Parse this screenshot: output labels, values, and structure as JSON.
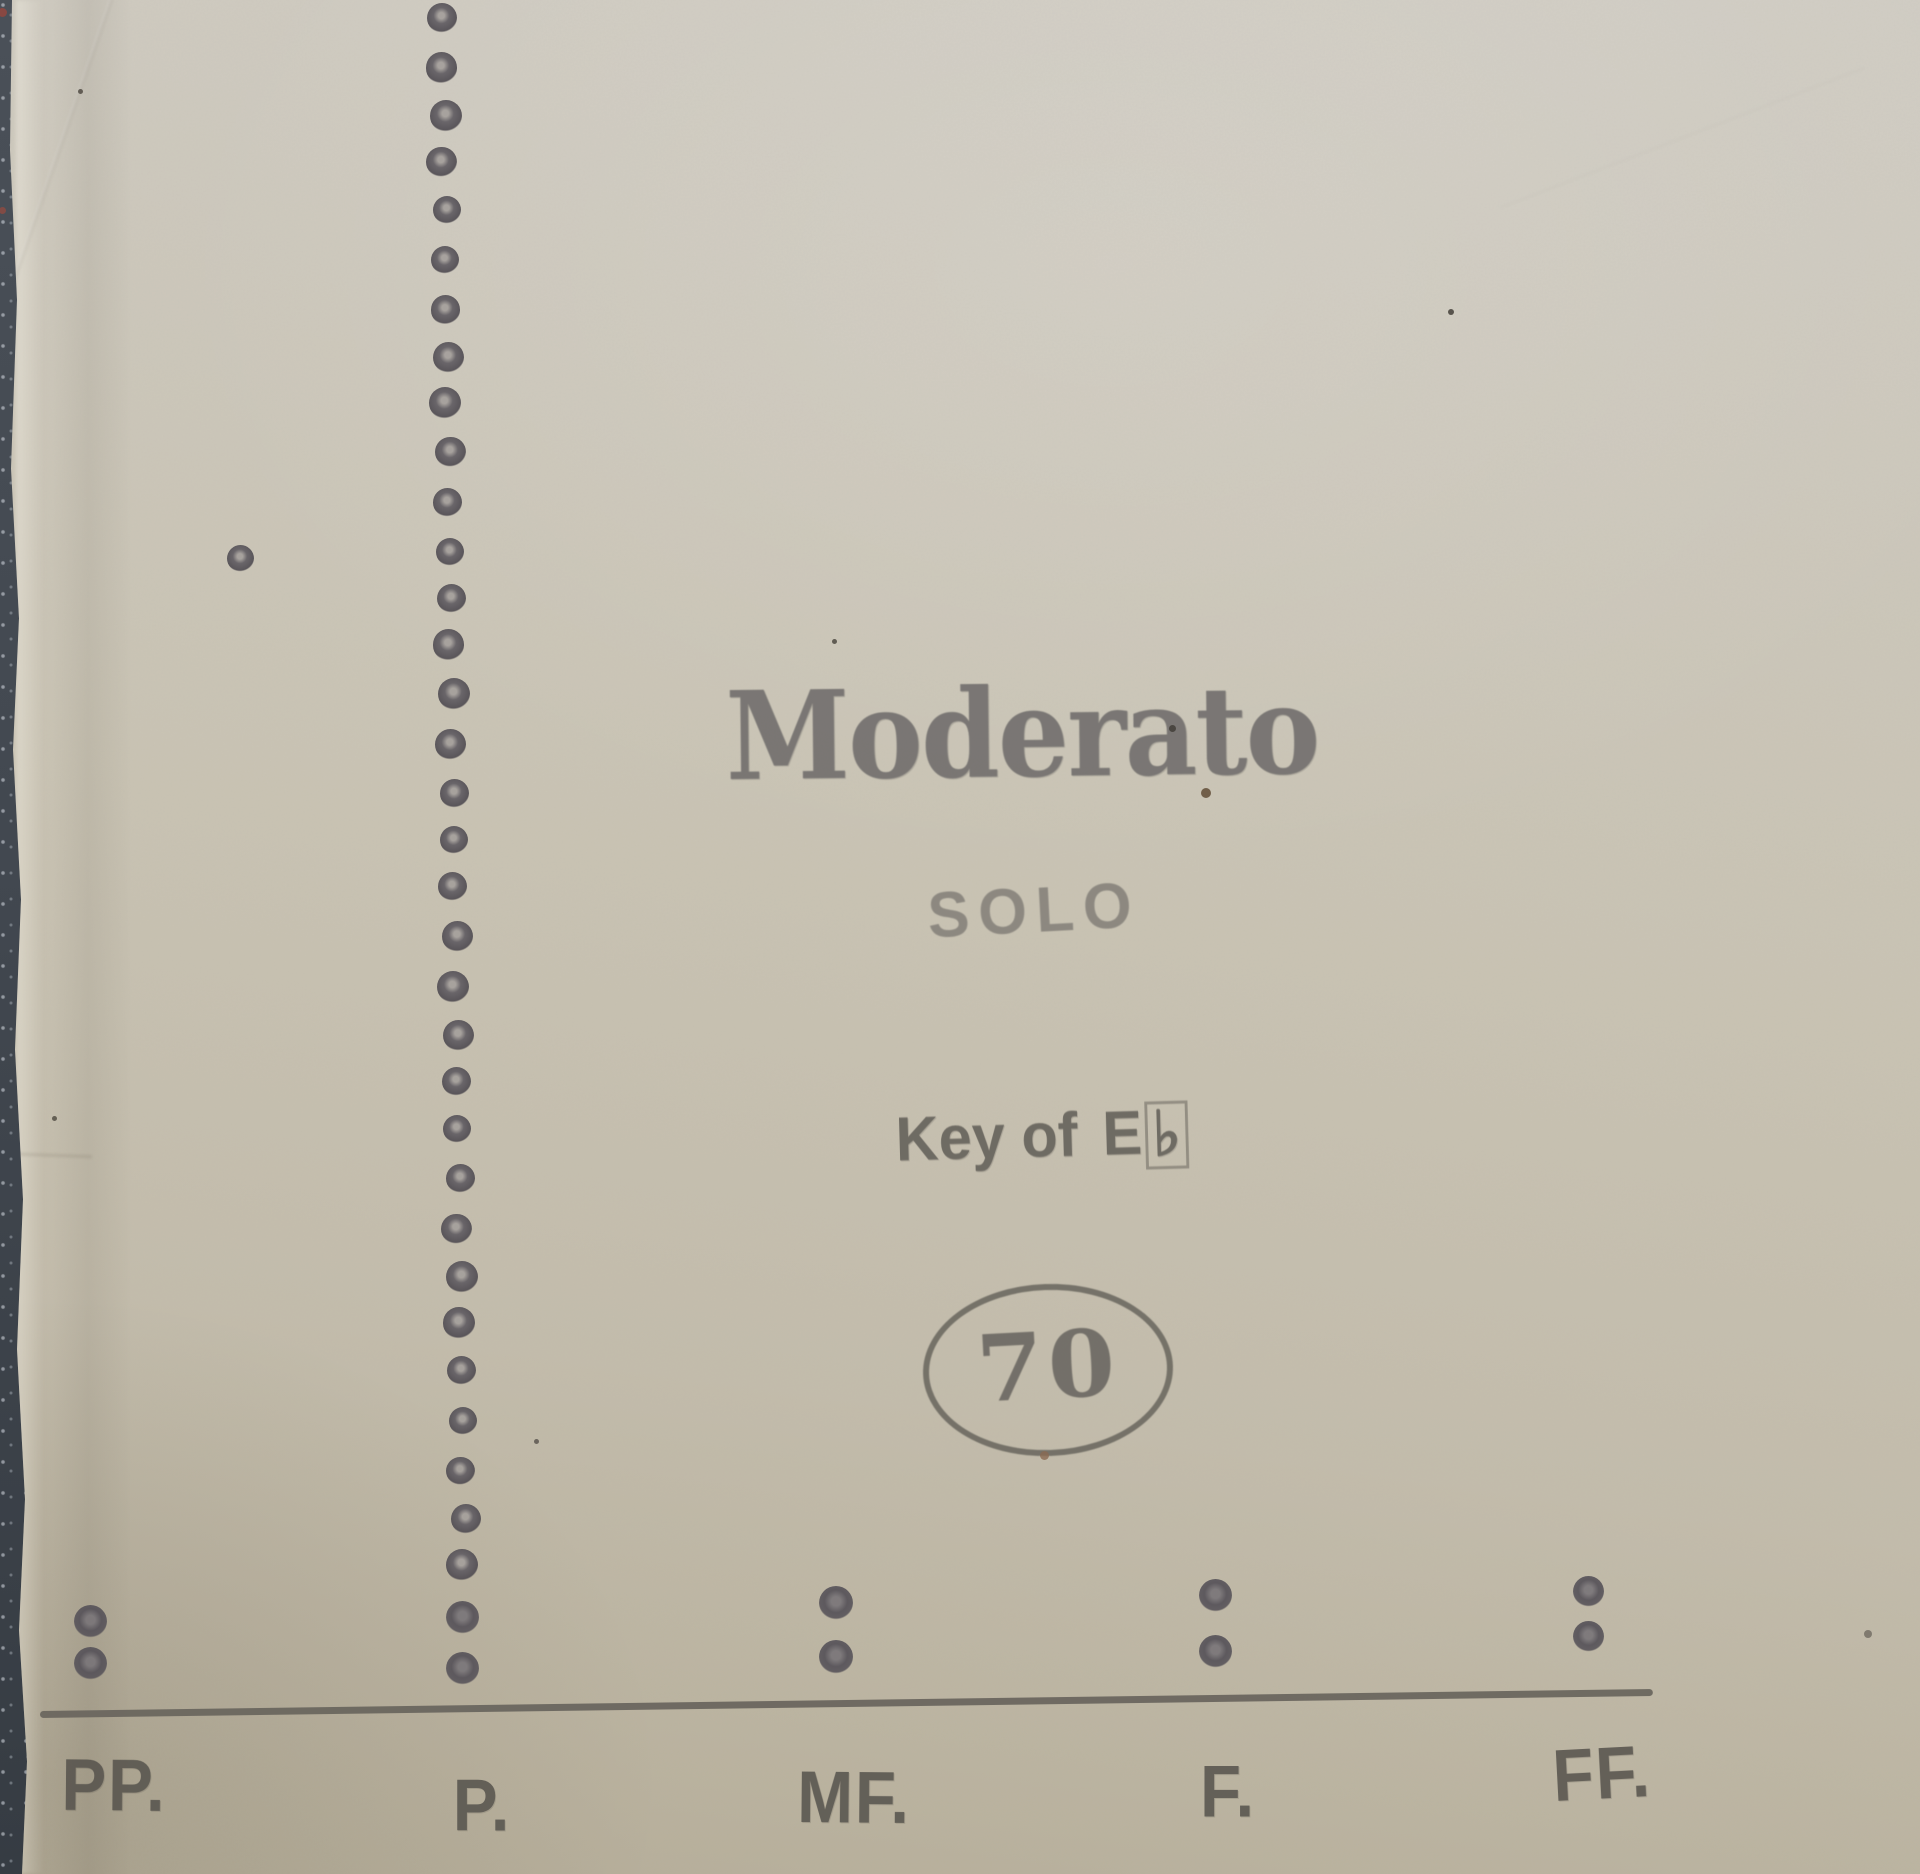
{
  "scene": {
    "description": "Photograph of a player piano roll leader on a dark surface",
    "paper_color": "#c9c3b3",
    "ink_color": "#5c5953",
    "surface_color": "#424850"
  },
  "stamps": {
    "tempo": "Moderato",
    "solo": "SOLO",
    "key_prefix": "Key of",
    "key_note": "E",
    "key_flat": "♭",
    "roll_number": "70"
  },
  "dynamics": {
    "labels": [
      "PP.",
      "P.",
      "MF.",
      "F.",
      "FF."
    ],
    "baseline": {
      "x1": 40,
      "y1": 1714,
      "x2": 1653,
      "y2": 1692,
      "thickness": 7
    },
    "marks": [
      {
        "label": "PP.",
        "label_x": 114,
        "label_y": 1786,
        "rot": 0.5,
        "dots": {
          "x": 90,
          "y1": 1621,
          "y2": 1663,
          "d": 33
        }
      },
      {
        "label": "P.",
        "label_x": 482,
        "label_y": 1806,
        "rot": 0,
        "dots": {
          "x": 462,
          "y1": 1617,
          "y2": 1668,
          "d": 33
        }
      },
      {
        "label": "MF.",
        "label_x": 854,
        "label_y": 1798,
        "rot": 0.5,
        "dots": {
          "x": 836,
          "y1": 1603,
          "y2": 1657,
          "d": 34
        }
      },
      {
        "label": "F.",
        "label_x": 1228,
        "label_y": 1792,
        "rot": 0,
        "dots": {
          "x": 1215,
          "y1": 1595,
          "y2": 1651,
          "d": 33
        }
      },
      {
        "label": "FF.",
        "label_x": 1602,
        "label_y": 1774,
        "rot": -3,
        "dots": {
          "x": 1588,
          "y1": 1591,
          "y2": 1636,
          "d": 31
        }
      }
    ]
  },
  "perforations": {
    "column": {
      "x_top": 442,
      "x_bottom": 464,
      "y_start": 18,
      "y_end": 1566,
      "count": 33,
      "diameter": 30
    },
    "stray_dot": {
      "x": 240,
      "y": 558,
      "d": 27
    }
  },
  "specks": [
    {
      "x": 80,
      "y": 91,
      "d": 5,
      "color": "#4a453d"
    },
    {
      "x": 54,
      "y": 1118,
      "d": 5,
      "color": "#4c473f"
    },
    {
      "x": 834,
      "y": 641,
      "d": 5,
      "color": "#45413a"
    },
    {
      "x": 1172,
      "y": 728,
      "d": 7,
      "color": "#3f3b34"
    },
    {
      "x": 1206,
      "y": 793,
      "d": 10,
      "color": "#5a452e"
    },
    {
      "x": 1451,
      "y": 312,
      "d": 6,
      "color": "#3a362f"
    },
    {
      "x": 1044,
      "y": 1455,
      "d": 9,
      "color": "#8a6a52"
    },
    {
      "x": 536,
      "y": 1441,
      "d": 5,
      "color": "#55504a"
    },
    {
      "x": 1868,
      "y": 1634,
      "d": 8,
      "color": "#6f6a60"
    }
  ],
  "edge_marks": [
    {
      "x": 2,
      "y": 12,
      "d": 9,
      "color": "#a34439"
    },
    {
      "x": 2,
      "y": 210,
      "d": 7,
      "color": "#9a4a3f"
    }
  ]
}
